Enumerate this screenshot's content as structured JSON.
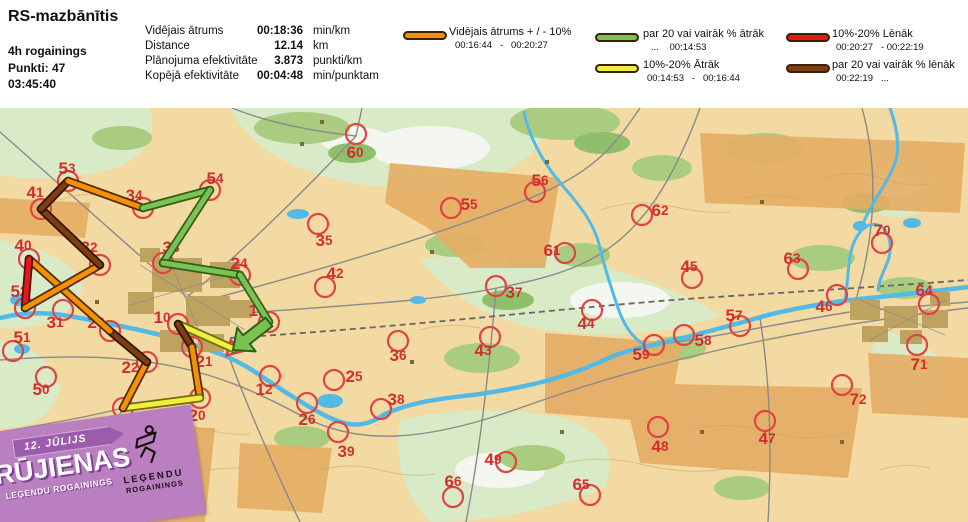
{
  "header": {
    "title": "RS-mazbānītis",
    "info": [
      "4h rogainings",
      "Punkti: 47",
      "03:45:40"
    ],
    "stats": [
      {
        "label": "Vidējais ātrums",
        "value": "00:18:36",
        "unit": "min/km"
      },
      {
        "label": "Distance",
        "value": "12.14",
        "unit": "km"
      },
      {
        "label": "Plānojuma efektivitāte",
        "value": "3.873",
        "unit": "punkti/km"
      },
      {
        "label": "Kopējā efektivitāte",
        "value": "00:04:48",
        "unit": "min/punktam"
      }
    ]
  },
  "legend": {
    "items": [
      {
        "key": "orange",
        "label": "Vidējais ātrums + / - 10%",
        "range": "00:16:44   -   00:20:27"
      },
      {
        "key": "green",
        "label": "par 20 vai vairāk % ātrāk",
        "range": "...    00:14:53"
      },
      {
        "key": "yellow",
        "label": "10%-20% Ātrāk",
        "range": "00:14:53   -   00:16:44"
      },
      {
        "key": "red",
        "label": "10%-20% Lēnāk",
        "range": "00:20:27   - 00:22:19"
      },
      {
        "key": "brown",
        "label": "par 20 vai vairāk % lēnāk",
        "range": "00:22:19   ..."
      }
    ]
  },
  "badge": {
    "date": "12. JŪLIJS",
    "title": "RŪJIENAS",
    "subtitle": "LEĢENDU ROGAININGS",
    "logo_top": "LEĢENDU",
    "logo_bottom": "ROGAININGS"
  },
  "map": {
    "circle_color": "#E04343",
    "label_color": "#D22E2E",
    "start_color": "#E23C50",
    "colors": {
      "orange": {
        "fill": "#F29103",
        "edge": "#53290A"
      },
      "green": {
        "fill": "#7CC253",
        "edge": "#2C611B"
      },
      "yellow": {
        "fill": "#F2EE3E",
        "edge": "#6E6E10"
      },
      "red": {
        "fill": "#DC1B1B",
        "edge": "#5D0A0A"
      },
      "brown": {
        "fill": "#7E3E10",
        "edge": "#2D1505"
      }
    },
    "start": [
      234,
      349
    ],
    "finish": [
      233,
      350
    ],
    "start_triangle": "230.7,340.3 226.6,355.4 241.7,351.3",
    "checkpoints": [
      {
        "id": "10",
        "x": 178,
        "y": 324,
        "lx": 162,
        "ly": 317,
        "visited": true
      },
      {
        "id": "21",
        "x": 192,
        "y": 347,
        "lx": 204,
        "ly": 361,
        "visited": true
      },
      {
        "id": "20",
        "x": 200,
        "y": 398,
        "lx": 197,
        "ly": 415,
        "visited": true
      },
      {
        "id": "30",
        "x": 123,
        "y": 408,
        "lx": 118,
        "ly": 422,
        "visited": true
      },
      {
        "id": "22",
        "x": 147,
        "y": 362,
        "lx": 130,
        "ly": 367,
        "visited": true
      },
      {
        "id": "23",
        "x": 110,
        "y": 331,
        "lx": 96,
        "ly": 322,
        "visited": true
      },
      {
        "id": "40",
        "x": 29,
        "y": 259,
        "lx": 23,
        "ly": 245,
        "visited": true
      },
      {
        "id": "52",
        "x": 25,
        "y": 308,
        "lx": 19,
        "ly": 291,
        "visited": true
      },
      {
        "id": "32",
        "x": 100,
        "y": 265,
        "lx": 89,
        "ly": 247,
        "visited": true
      },
      {
        "id": "41",
        "x": 41,
        "y": 209,
        "lx": 35,
        "ly": 192,
        "visited": true
      },
      {
        "id": "53",
        "x": 68,
        "y": 181,
        "lx": 67,
        "ly": 168,
        "visited": true
      },
      {
        "id": "34",
        "x": 143,
        "y": 208,
        "lx": 134,
        "ly": 195,
        "visited": true
      },
      {
        "id": "54",
        "x": 210,
        "y": 190,
        "lx": 215,
        "ly": 178,
        "visited": true
      },
      {
        "id": "33",
        "x": 163,
        "y": 263,
        "lx": 171,
        "ly": 247,
        "visited": true
      },
      {
        "id": "24",
        "x": 240,
        "y": 275,
        "lx": 239,
        "ly": 263,
        "visited": true
      },
      {
        "id": "11",
        "x": 269,
        "y": 322,
        "lx": 257,
        "ly": 310,
        "visited": true
      },
      {
        "id": "60",
        "x": 356,
        "y": 134,
        "lx": 355,
        "ly": 152,
        "visited": false
      },
      {
        "id": "35",
        "x": 318,
        "y": 224,
        "lx": 324,
        "ly": 240,
        "visited": false
      },
      {
        "id": "55",
        "x": 451,
        "y": 208,
        "lx": 469,
        "ly": 204,
        "visited": false
      },
      {
        "id": "56",
        "x": 535,
        "y": 192,
        "lx": 540,
        "ly": 180,
        "visited": false
      },
      {
        "id": "42",
        "x": 325,
        "y": 287,
        "lx": 335,
        "ly": 273,
        "visited": false
      },
      {
        "id": "61",
        "x": 565,
        "y": 253,
        "lx": 552,
        "ly": 250,
        "visited": false
      },
      {
        "id": "37",
        "x": 496,
        "y": 286,
        "lx": 514,
        "ly": 292,
        "visited": false
      },
      {
        "id": "36",
        "x": 398,
        "y": 341,
        "lx": 398,
        "ly": 355,
        "visited": false
      },
      {
        "id": "25",
        "x": 334,
        "y": 380,
        "lx": 354,
        "ly": 376,
        "visited": false
      },
      {
        "id": "44",
        "x": 592,
        "y": 310,
        "lx": 586,
        "ly": 323,
        "visited": false
      },
      {
        "id": "43",
        "x": 490,
        "y": 337,
        "lx": 483,
        "ly": 350,
        "visited": false
      },
      {
        "id": "62",
        "x": 642,
        "y": 215,
        "lx": 660,
        "ly": 210,
        "visited": false
      },
      {
        "id": "45",
        "x": 692,
        "y": 278,
        "lx": 689,
        "ly": 266,
        "visited": false
      },
      {
        "id": "63",
        "x": 798,
        "y": 269,
        "lx": 792,
        "ly": 258,
        "visited": false
      },
      {
        "id": "70",
        "x": 882,
        "y": 243,
        "lx": 882,
        "ly": 230,
        "visited": false
      },
      {
        "id": "46",
        "x": 837,
        "y": 295,
        "lx": 824,
        "ly": 306,
        "visited": false
      },
      {
        "id": "64",
        "x": 929,
        "y": 304,
        "lx": 924,
        "ly": 290,
        "visited": false
      },
      {
        "id": "57",
        "x": 740,
        "y": 326,
        "lx": 734,
        "ly": 315,
        "visited": false
      },
      {
        "id": "58",
        "x": 684,
        "y": 335,
        "lx": 703,
        "ly": 340,
        "visited": false
      },
      {
        "id": "59",
        "x": 654,
        "y": 345,
        "lx": 641,
        "ly": 354,
        "visited": false
      },
      {
        "id": "71",
        "x": 917,
        "y": 345,
        "lx": 919,
        "ly": 364,
        "visited": false
      },
      {
        "id": "72",
        "x": 842,
        "y": 385,
        "lx": 858,
        "ly": 399,
        "visited": false
      },
      {
        "id": "12",
        "x": 270,
        "y": 376,
        "lx": 264,
        "ly": 389,
        "visited": false
      },
      {
        "id": "26",
        "x": 307,
        "y": 403,
        "lx": 307,
        "ly": 419,
        "visited": false
      },
      {
        "id": "31",
        "x": 63,
        "y": 310,
        "lx": 55,
        "ly": 322,
        "visited": false
      },
      {
        "id": "51",
        "x": 13,
        "y": 351,
        "lx": 22,
        "ly": 337,
        "visited": false
      },
      {
        "id": "50",
        "x": 46,
        "y": 377,
        "lx": 41,
        "ly": 389,
        "visited": false
      },
      {
        "id": "38",
        "x": 381,
        "y": 409,
        "lx": 396,
        "ly": 399,
        "visited": false
      },
      {
        "id": "39",
        "x": 338,
        "y": 432,
        "lx": 346,
        "ly": 451,
        "visited": false
      },
      {
        "id": "49",
        "x": 506,
        "y": 462,
        "lx": 493,
        "ly": 459,
        "visited": false
      },
      {
        "id": "66",
        "x": 453,
        "y": 497,
        "lx": 453,
        "ly": 481,
        "visited": false
      },
      {
        "id": "65",
        "x": 590,
        "y": 495,
        "lx": 581,
        "ly": 484,
        "visited": false
      },
      {
        "id": "47",
        "x": 765,
        "y": 421,
        "lx": 767,
        "ly": 438,
        "visited": false
      },
      {
        "id": "48",
        "x": 658,
        "y": 427,
        "lx": 660,
        "ly": 446,
        "visited": false
      }
    ],
    "route": [
      {
        "from": "start",
        "to": "10",
        "color": "yellow"
      },
      {
        "from": "10",
        "to": "21",
        "color": "brown"
      },
      {
        "from": "21",
        "to": "20",
        "color": "orange"
      },
      {
        "from": "20",
        "to": "30",
        "color": "yellow"
      },
      {
        "from": "30",
        "to": "22",
        "color": "orange"
      },
      {
        "from": "22",
        "to": "23",
        "color": "brown"
      },
      {
        "from": "23",
        "to": "40",
        "color": "orange"
      },
      {
        "from": "40",
        "to": "52",
        "color": "red"
      },
      {
        "from": "52",
        "to": "32",
        "color": "orange"
      },
      {
        "from": "32",
        "to": "41",
        "color": "brown"
      },
      {
        "from": "41",
        "to": "53",
        "color": "brown"
      },
      {
        "from": "53",
        "to": "34",
        "color": "orange"
      },
      {
        "from": "34",
        "to": "54",
        "color": "green"
      },
      {
        "from": "54",
        "to": "33",
        "color": "green"
      },
      {
        "from": "33",
        "to": "24",
        "color": "green"
      },
      {
        "from": "24",
        "to": "11",
        "color": "green"
      },
      {
        "from": "11",
        "to": "finish",
        "color": "green",
        "arrow": true
      }
    ]
  }
}
